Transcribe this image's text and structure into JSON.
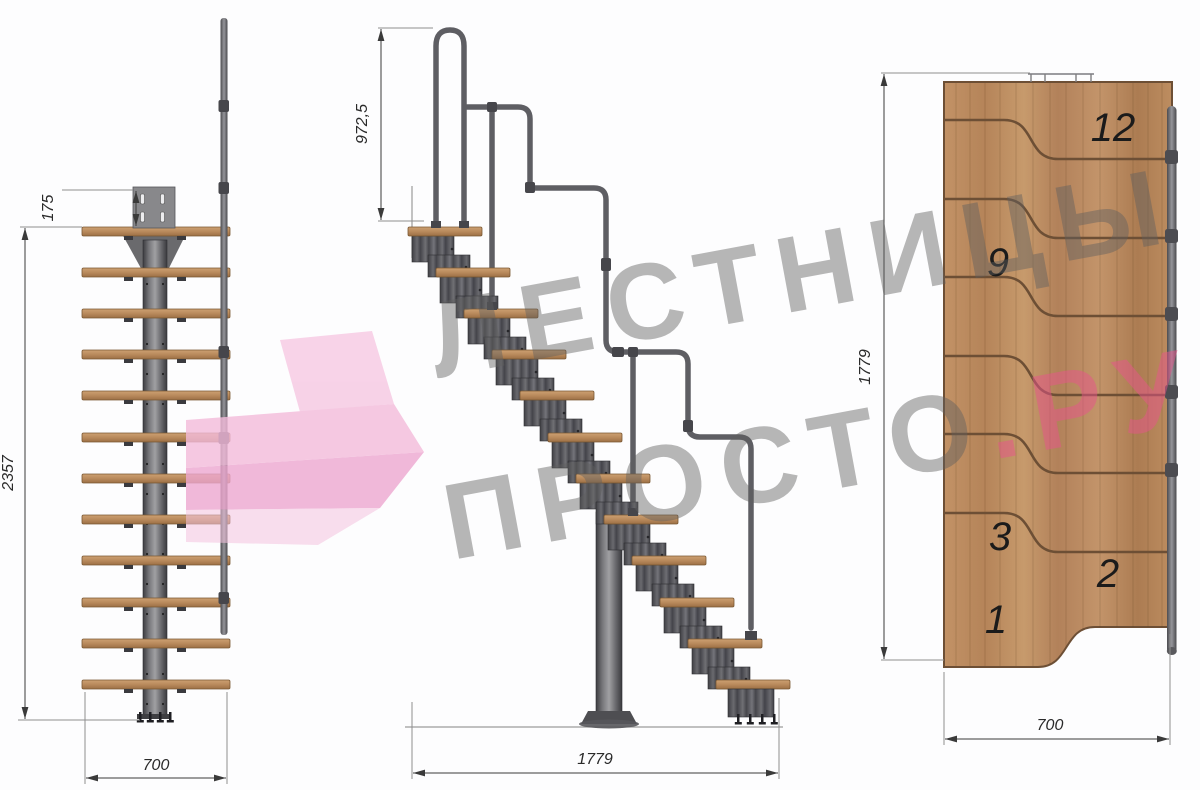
{
  "watermark": {
    "line1": "ЛЕСТНИЦЫ",
    "line2_gray": "ПРОСТО",
    "line2_pink": ".РУ"
  },
  "front_view": {
    "dim_plate_offset": "175",
    "dim_total_height": "2357",
    "dim_width": "700"
  },
  "side_view": {
    "dim_handrail_height": "972,5",
    "dim_total_length": "1779"
  },
  "plan_view": {
    "dim_total_length": "1779",
    "dim_width": "700",
    "tread_numbers": [
      "12",
      "9",
      "3",
      "2",
      "1"
    ]
  },
  "colors": {
    "watermark_gray": "#5f5f5f",
    "watermark_pink": "#e8548c",
    "logo_pink": "#f3b7d8",
    "wood": "#b98a5c",
    "metal": "#55555a",
    "dimension": "#3a3a3a"
  }
}
